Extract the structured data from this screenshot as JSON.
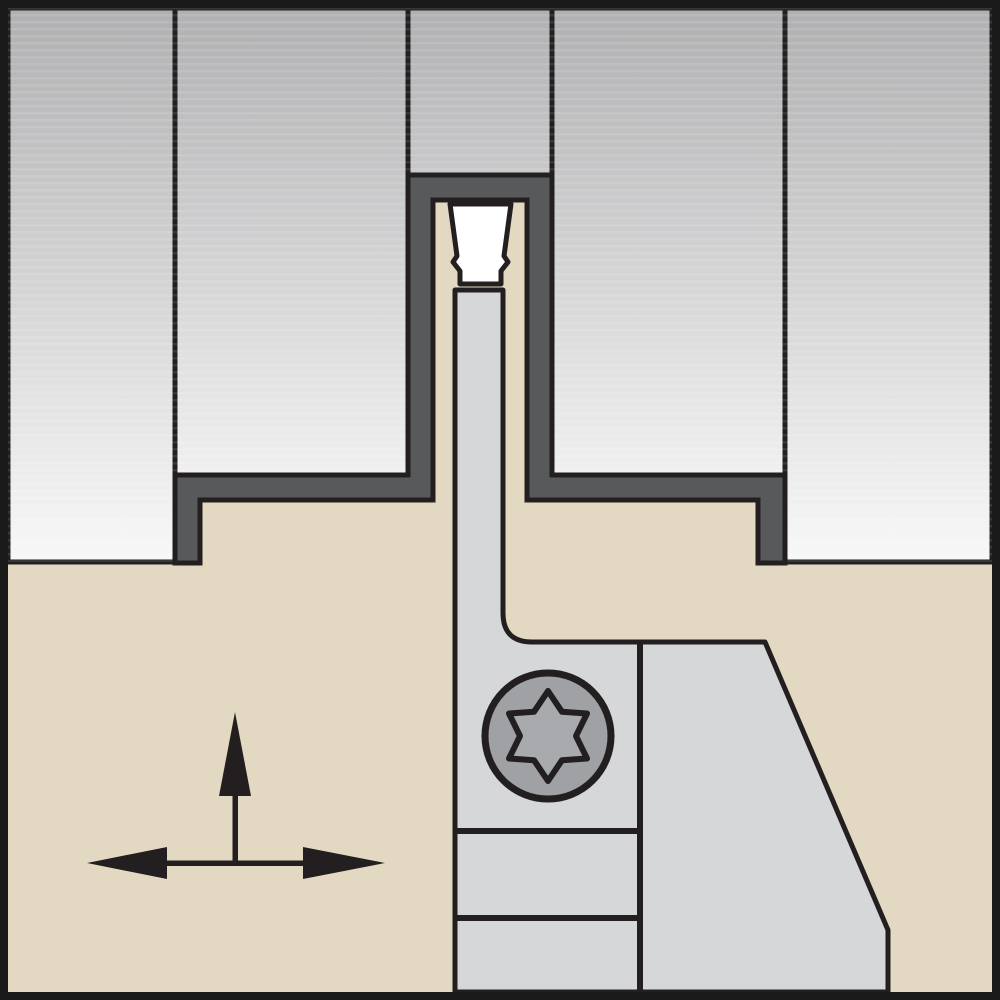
{
  "diagram": {
    "type": "technical-illustration",
    "subject": "Cut-off / grooving blade with indexable insert engaged in a workpiece groove, front view",
    "elements": {
      "workpiece": "workpiece cross-section shown as gradient gray blocks",
      "groove_profile": "machined groove slot profile",
      "tool_holder": "tool holder / blade body",
      "cutting_insert": "indexable cutting insert at top of blade",
      "support_block": "blade support and clamp block",
      "clamp_screw": "torx-head clamp screw",
      "feed_arrows": "feed direction arrows: vertical plunge and horizontal traverse"
    }
  },
  "colors": {
    "line_black": "#231f20",
    "groove_dark_gray": "#58595b",
    "holder_tan": "#e3d9c2",
    "support_gray": "#d6d7d9",
    "insert_white": "#ffffff",
    "screw_gray": "#9fa1a4",
    "screw_star_gray": "#a8aaad",
    "arrow_black": "#231f20",
    "workpiece_gradient_top": "#b0b0b2",
    "workpiece_gradient_bottom": "#f8f8f8",
    "frame_black": "#1a1a1a"
  }
}
